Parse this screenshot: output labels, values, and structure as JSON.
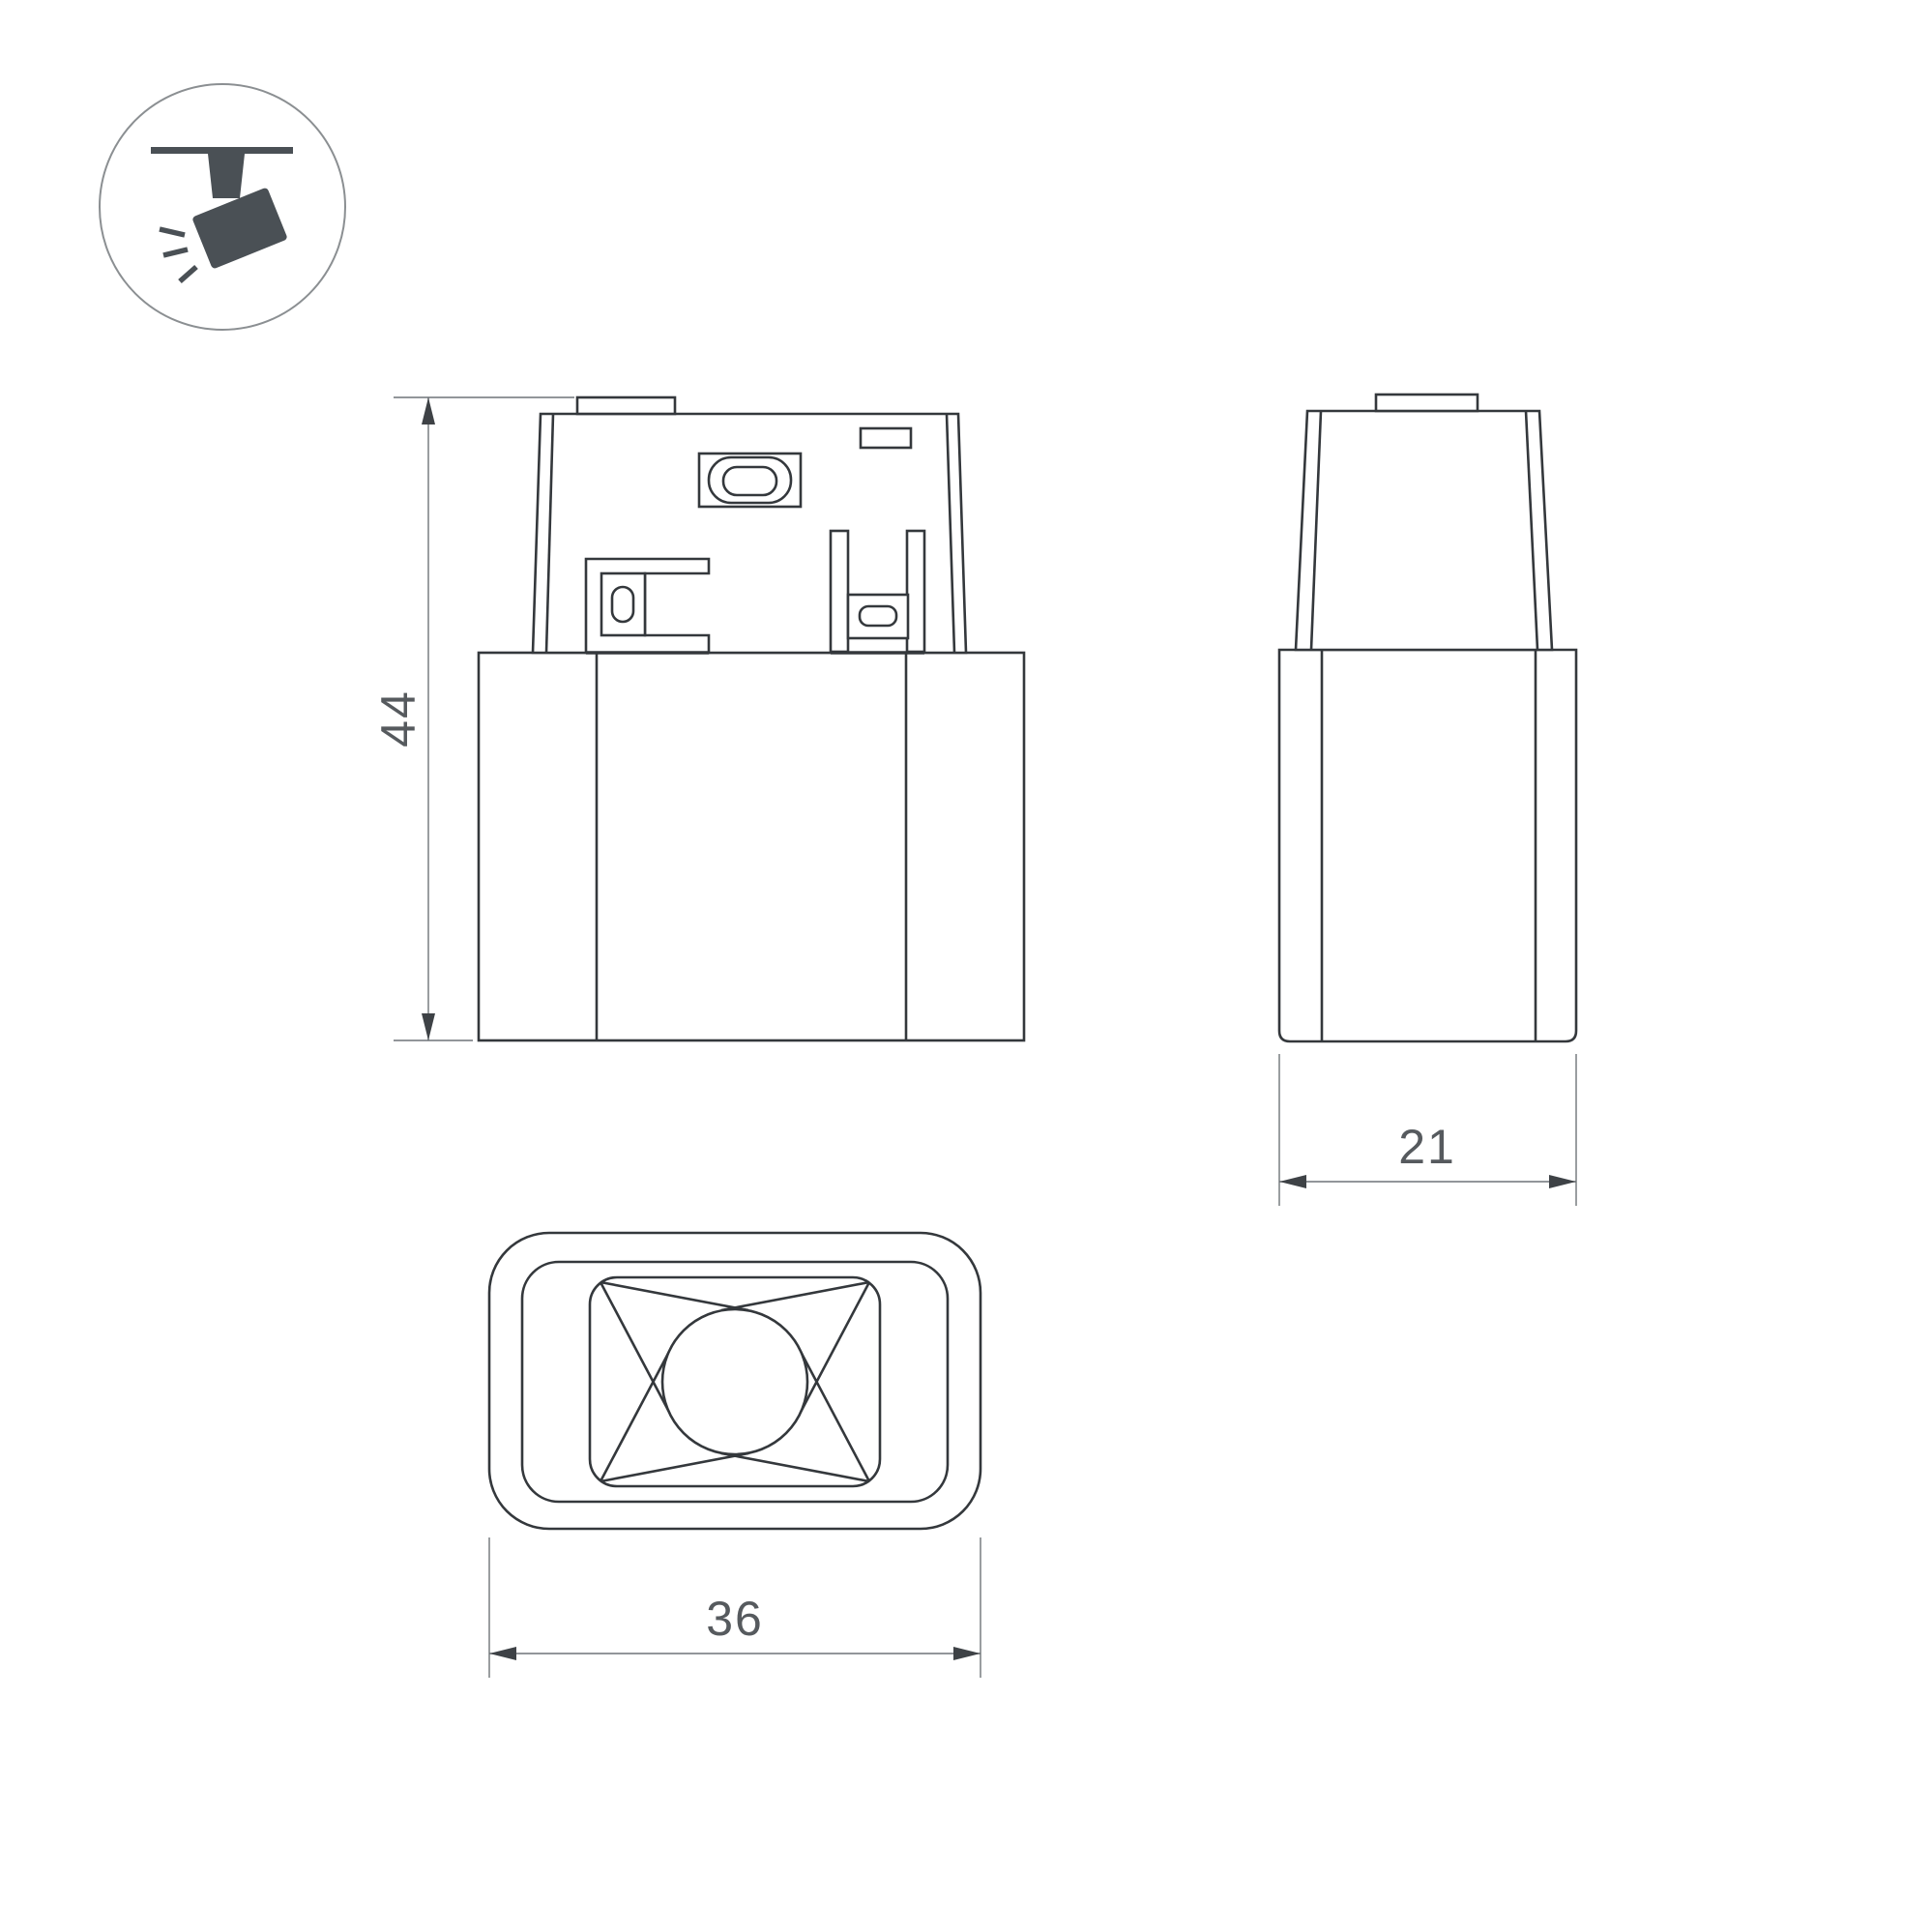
{
  "document": {
    "type": "technical-dimension-drawing",
    "subject": "magnetic track spotlight luminaire",
    "background": "#ffffff"
  },
  "icon": {
    "name": "track-spotlight",
    "description": "ceiling track with tilted spotlight emitting light rays"
  },
  "views": {
    "front": {
      "name": "front view",
      "dimension": {
        "label": "44",
        "axis": "height"
      }
    },
    "side": {
      "name": "side view",
      "dimension": {
        "label": "21",
        "axis": "width"
      }
    },
    "bottom": {
      "name": "bottom view",
      "dimension": {
        "label": "36",
        "axis": "width"
      }
    }
  },
  "colors": {
    "outline": "#34383c",
    "dim": "#6f7478",
    "arrow": "#3e4246",
    "text": "#565a5e",
    "icon": "#4a5055",
    "ring": "#8b8f92"
  }
}
